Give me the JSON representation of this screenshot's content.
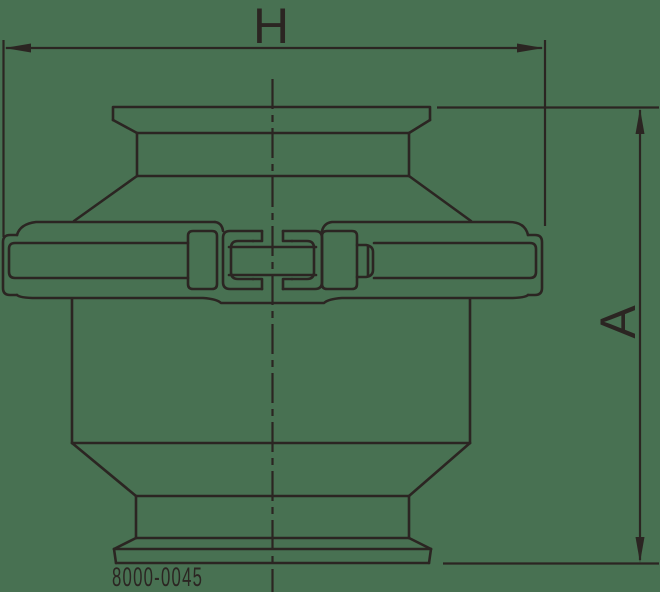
{
  "drawing": {
    "title": "valve-outline-drawing",
    "labels": {
      "dimension_h": "H",
      "dimension_a": "A",
      "part_number": "8000-0045"
    },
    "colors": {
      "background": "#487152",
      "line": "#2b2522"
    }
  }
}
